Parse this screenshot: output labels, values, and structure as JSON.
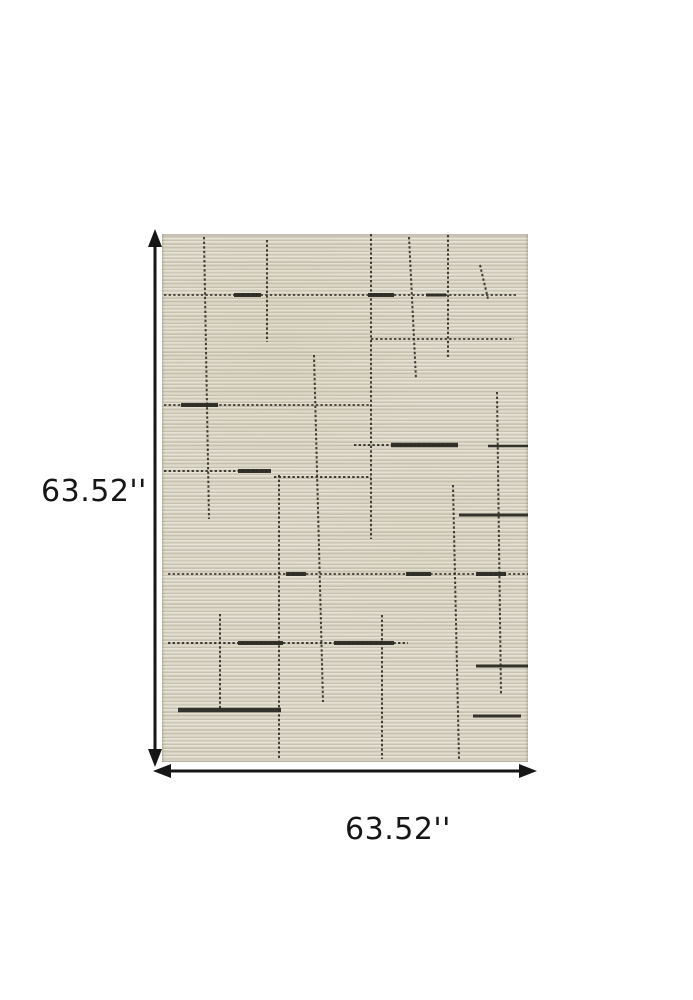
{
  "dimensions": {
    "height_label": "63.52''",
    "width_label": "63.52''"
  },
  "icons": {
    "vertical_arrow": "double-headed-arrow-vertical",
    "horizontal_arrow": "double-headed-arrow-horizontal"
  },
  "colors": {
    "background": "#ffffff",
    "annotation": "#161616",
    "pattern_line": "#2b2a23",
    "rug_light": "#e6e2d5",
    "rug_mid": "#d7d2c2",
    "rug_dark": "#c6c1b0"
  },
  "rug_pattern": {
    "description": "cream ribbed rug with irregular dark stitched grid lines",
    "width": 366,
    "height": 528,
    "lines": [
      [
        42,
        3,
        47,
        285,
        2,
        "d"
      ],
      [
        105,
        6,
        105,
        108,
        2,
        "d"
      ],
      [
        209,
        0,
        209,
        305,
        2,
        "d"
      ],
      [
        247,
        3,
        254,
        145,
        2,
        "d"
      ],
      [
        286,
        1,
        286,
        123,
        2,
        "d"
      ],
      [
        318,
        31,
        326,
        65,
        2,
        "d"
      ],
      [
        152,
        121,
        161,
        468,
        2,
        "d"
      ],
      [
        117,
        241,
        117,
        525,
        2,
        "d"
      ],
      [
        291,
        251,
        297,
        525,
        2,
        "d"
      ],
      [
        335,
        158,
        339,
        460,
        2,
        "d"
      ],
      [
        220,
        381,
        220,
        525,
        2,
        "d"
      ],
      [
        58,
        380,
        58,
        475,
        2,
        "d"
      ],
      [
        2,
        61,
        356,
        61,
        1.8,
        "d"
      ],
      [
        72,
        61,
        99,
        61,
        4,
        "s"
      ],
      [
        206,
        61,
        232,
        61,
        4,
        "s"
      ],
      [
        264,
        61,
        284,
        61,
        3,
        "s"
      ],
      [
        209,
        105,
        352,
        105,
        1.8,
        "d"
      ],
      [
        2,
        171,
        209,
        171,
        1.8,
        "d"
      ],
      [
        19,
        171,
        56,
        171,
        4,
        "s"
      ],
      [
        192,
        211,
        296,
        211,
        2,
        "d"
      ],
      [
        229,
        211,
        296,
        211,
        4.5,
        "s"
      ],
      [
        326,
        212,
        366,
        212,
        2.5,
        "s"
      ],
      [
        2,
        237,
        109,
        237,
        2,
        "d"
      ],
      [
        76,
        237,
        109,
        237,
        4,
        "s"
      ],
      [
        112,
        243,
        209,
        243,
        2,
        "d"
      ],
      [
        297,
        281,
        366,
        281,
        3,
        "s"
      ],
      [
        6,
        340,
        366,
        340,
        1.8,
        "d"
      ],
      [
        124,
        340,
        144,
        340,
        4,
        "s"
      ],
      [
        244,
        340,
        269,
        340,
        4,
        "s"
      ],
      [
        314,
        340,
        344,
        340,
        4,
        "s"
      ],
      [
        6,
        409,
        246,
        409,
        2,
        "d"
      ],
      [
        76,
        409,
        121,
        409,
        4,
        "s"
      ],
      [
        172,
        409,
        232,
        409,
        4,
        "s"
      ],
      [
        314,
        432,
        366,
        432,
        3,
        "s"
      ],
      [
        16,
        476,
        119,
        476,
        4.5,
        "s"
      ],
      [
        311,
        482,
        359,
        482,
        3,
        "s"
      ]
    ]
  }
}
